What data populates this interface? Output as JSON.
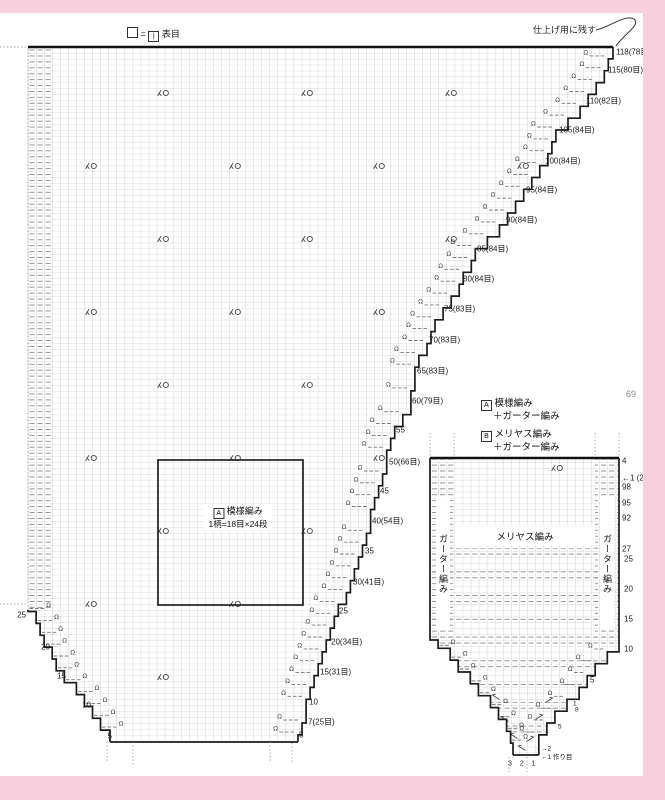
{
  "page": {
    "number": "69",
    "watermark": "PassionForum.ru"
  },
  "colors": {
    "pink_border": "#f8cfdc",
    "outline": "#1c1c1c",
    "grid": "#b3b3b3",
    "dash": "#8c8c8c"
  },
  "top_legend": {
    "equals": "=",
    "knit_symbol": "|",
    "label": "表目"
  },
  "callout": {
    "text": "仕上げ用に残す"
  },
  "legend": {
    "a_tag": "A",
    "a_line1": "模様編み",
    "a_line2": "＋ガーター編み",
    "b_tag": "B",
    "b_line1": "メリヤス編み",
    "b_line2": "＋ガーター編み"
  },
  "main_chart": {
    "pattern_box": {
      "tag": "A",
      "title": "模様編み",
      "subtitle": "1柄=18目×24段"
    },
    "right_labels": [
      {
        "t": "118(78目)",
        "x": 616,
        "y": 52
      },
      {
        "t": "115(80目)",
        "x": 608,
        "y": 70
      },
      {
        "t": "110(82目)",
        "x": 586,
        "y": 101
      },
      {
        "t": "105(84目)",
        "x": 559,
        "y": 130
      },
      {
        "t": "100(84目)",
        "x": 545,
        "y": 161
      },
      {
        "t": "95(84目)",
        "x": 526,
        "y": 190
      },
      {
        "t": "90(84目)",
        "x": 506,
        "y": 220
      },
      {
        "t": "85(84目)",
        "x": 477,
        "y": 249
      },
      {
        "t": "80(84目)",
        "x": 463,
        "y": 279
      },
      {
        "t": "75(83目)",
        "x": 444,
        "y": 309
      },
      {
        "t": "70(83目)",
        "x": 429,
        "y": 340
      },
      {
        "t": "65(83目)",
        "x": 417,
        "y": 371
      },
      {
        "t": "60(79目)",
        "x": 412,
        "y": 401
      },
      {
        "t": "55",
        "x": 396,
        "y": 430
      },
      {
        "t": "50(66目)",
        "x": 389,
        "y": 462
      },
      {
        "t": "45",
        "x": 380,
        "y": 491
      },
      {
        "t": "40(54目)",
        "x": 372,
        "y": 521
      },
      {
        "t": "35",
        "x": 365,
        "y": 551
      },
      {
        "t": "30(41目)",
        "x": 353,
        "y": 582
      },
      {
        "t": "25",
        "x": 339,
        "y": 611
      },
      {
        "t": "20(34目)",
        "x": 331,
        "y": 642
      },
      {
        "t": "15(31目)",
        "x": 320,
        "y": 672
      },
      {
        "t": "10",
        "x": 309,
        "y": 702
      },
      {
        "t": "7(25目)",
        "x": 308,
        "y": 722
      },
      {
        "t": "5",
        "x": 299,
        "y": 735
      }
    ],
    "left_labels": [
      {
        "t": "25",
        "x": 26,
        "y": 615,
        "a": "r"
      },
      {
        "t": "20",
        "x": 50,
        "y": 647,
        "a": "r"
      },
      {
        "t": "15",
        "x": 66,
        "y": 676,
        "a": "r"
      },
      {
        "t": "10",
        "x": 91,
        "y": 705,
        "a": "r"
      },
      {
        "t": "5",
        "x": 112,
        "y": 736,
        "a": "r"
      }
    ],
    "decrease_symbols": [
      [
        163,
        93
      ],
      [
        307,
        93
      ],
      [
        451,
        93
      ],
      [
        91,
        166
      ],
      [
        235,
        166
      ],
      [
        379,
        166
      ],
      [
        523,
        166
      ],
      [
        163,
        239
      ],
      [
        307,
        239
      ],
      [
        451,
        239
      ],
      [
        91,
        312
      ],
      [
        235,
        312
      ],
      [
        379,
        312
      ],
      [
        163,
        385
      ],
      [
        307,
        385
      ],
      [
        91,
        458
      ],
      [
        235,
        458
      ],
      [
        379,
        458
      ],
      [
        163,
        531
      ],
      [
        307,
        531
      ],
      [
        91,
        604
      ],
      [
        235,
        604
      ],
      [
        163,
        677
      ]
    ]
  },
  "small_chart": {
    "stockinette_label": "メリヤス編み",
    "garter_label": "ガーター編み",
    "right_labels": [
      {
        "t": "4",
        "x": 622,
        "y": 461
      },
      {
        "t": "←1 (23目)",
        "x": 622,
        "y": 478
      },
      {
        "t": "98",
        "x": 622,
        "y": 487
      },
      {
        "t": "95",
        "x": 622,
        "y": 503
      },
      {
        "t": "92",
        "x": 622,
        "y": 518
      },
      {
        "t": "27",
        "x": 622,
        "y": 549
      },
      {
        "t": "25",
        "x": 624,
        "y": 559
      },
      {
        "t": "20",
        "x": 624,
        "y": 589
      },
      {
        "t": "15",
        "x": 624,
        "y": 619
      },
      {
        "t": "10",
        "x": 624,
        "y": 649
      },
      {
        "t": "5",
        "x": 590,
        "y": 680
      },
      {
        "t": "1",
        "x": 573,
        "y": 704,
        "s": 6.5
      },
      {
        "t": "8",
        "x": 575,
        "y": 710,
        "s": 6.5
      },
      {
        "t": "5",
        "x": 558,
        "y": 727,
        "s": 6.5
      }
    ],
    "tip_labels": [
      {
        "t": "→2",
        "x": 541,
        "y": 749,
        "s": 6.5
      },
      {
        "t": "←1 作り目",
        "x": 541,
        "y": 756,
        "s": 6.5
      },
      {
        "t": "3 2 1",
        "x": 508,
        "y": 764,
        "s": 7,
        "sp": 3
      }
    ],
    "decrease_symbols": [
      [
        557,
        468
      ]
    ],
    "increase_symbols": [
      [
        496,
        697,
        -1
      ],
      [
        549,
        700,
        1
      ],
      [
        505,
        719,
        -1
      ],
      [
        539,
        717,
        1
      ],
      [
        514,
        736,
        -1
      ],
      [
        530,
        739,
        1
      ],
      [
        522,
        748,
        -1
      ]
    ]
  }
}
